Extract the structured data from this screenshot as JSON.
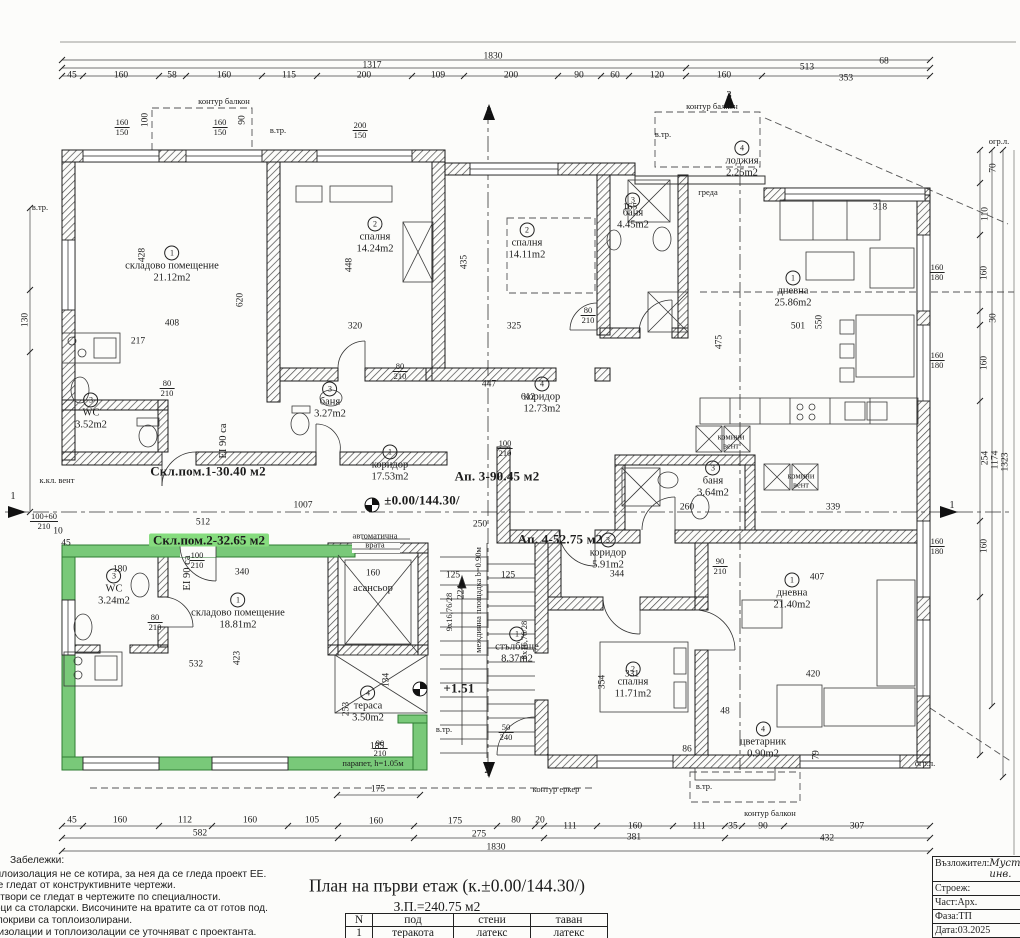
{
  "sheet": {
    "title": "План на първи етаж (к.±0.00/144.30/)",
    "area_total": "З.П.=240.75 м2",
    "notes_heading": "Забележки:",
    "notes": [
      "зидарски. Топлоизолация не се котира, за нея да се гледа проект ЕЕ.",
      "ни и шайби се гледат от конструктивните чертежи.",
      "лационните отвори се гледат в чертежите по специалности.",
      "ите за прозорци са столарски. Височините на вратите са от готов под.",
      "ни, еркери и покриви са топлоизолирани.",
      "риали, хидроизолации и топлоизолации се уточняват с проектанта."
    ],
    "finish_table": {
      "headers": [
        "N",
        "под",
        "стени",
        "таван"
      ],
      "rows": [
        [
          "1",
          "теракота",
          "латекс",
          "латекс"
        ]
      ]
    },
    "title_block": [
      {
        "label": "Възложител:",
        "value": "Мустафа и инв."
      },
      {
        "label": "Строеж:",
        "value": "п ("
      },
      {
        "label": "Част:Арх.",
        "value": "ч"
      },
      {
        "label": "Фаза:ТП",
        "value": "Г"
      },
      {
        "label": "Дата:03.2025",
        "value": ""
      }
    ]
  },
  "plan": {
    "rooms": [
      {
        "n": "1",
        "name": "складово помещение",
        "area": "21.12m2",
        "x": 172,
        "y": 265
      },
      {
        "n": "3",
        "name": "WC",
        "area": "3.52m2",
        "x": 91,
        "y": 412
      },
      {
        "n": "2",
        "name": "спалня",
        "area": "14.24m2",
        "x": 375,
        "y": 236
      },
      {
        "n": "3",
        "name": "баня",
        "area": "3.27m2",
        "x": 330,
        "y": 401
      },
      {
        "n": "2",
        "name": "спалня",
        "area": "14.11m2",
        "x": 527,
        "y": 242
      },
      {
        "n": "3",
        "name": "баня",
        "area": "4.45m2",
        "x": 633,
        "y": 212
      },
      {
        "n": "4",
        "name": "лоджия",
        "area": "2.25m2",
        "x": 742,
        "y": 160
      },
      {
        "n": "1",
        "name": "дневна",
        "area": "25.86m2",
        "x": 793,
        "y": 290
      },
      {
        "n": "4",
        "name": "коридор",
        "area": "12.73m2",
        "x": 542,
        "y": 396
      },
      {
        "n": "1",
        "name": "коридор",
        "area": "17.53m2",
        "x": 390,
        "y": 464
      },
      {
        "n": "3",
        "name": "WC",
        "area": "3.24m2",
        "x": 114,
        "y": 588
      },
      {
        "n": "1",
        "name": "складово помещение",
        "area": "18.81m2",
        "x": 238,
        "y": 612
      },
      {
        "n": "1",
        "name": "стълбище",
        "area": "8.37m2",
        "x": 517,
        "y": 646
      },
      {
        "n": "4",
        "name": "тераса",
        "area": "3.50m2",
        "x": 368,
        "y": 705
      },
      {
        "n": "3",
        "name": "коридор",
        "area": "5.91m2",
        "x": 608,
        "y": 552
      },
      {
        "n": "3",
        "name": "баня",
        "area": "3.64m2",
        "x": 713,
        "y": 480
      },
      {
        "n": "2",
        "name": "спалня",
        "area": "11.71m2",
        "x": 633,
        "y": 681
      },
      {
        "n": "1",
        "name": "дневна",
        "area": "21.40m2",
        "x": 792,
        "y": 592
      },
      {
        "n": "4",
        "name": "цветарник",
        "area": "0.90m2",
        "x": 763,
        "y": 741
      }
    ],
    "annotations": [
      [
        "1830",
        493,
        57,
        "d"
      ],
      [
        "1317",
        372,
        66,
        "d"
      ],
      [
        "513",
        807,
        68,
        "d"
      ],
      [
        "45",
        72,
        76,
        "d"
      ],
      [
        "160",
        121,
        76,
        "d"
      ],
      [
        "58",
        172,
        76,
        "d"
      ],
      [
        "160",
        224,
        76,
        "d"
      ],
      [
        "115",
        289,
        76,
        "d"
      ],
      [
        "200",
        364,
        76,
        "d"
      ],
      [
        "109",
        438,
        76,
        "d"
      ],
      [
        "200",
        511,
        76,
        "d"
      ],
      [
        "90",
        579,
        76,
        "d"
      ],
      [
        "60",
        615,
        76,
        "d"
      ],
      [
        "120",
        657,
        76,
        "d"
      ],
      [
        "160",
        724,
        76,
        "d"
      ],
      [
        "353",
        846,
        79,
        "d"
      ],
      [
        "45",
        72,
        821,
        "d"
      ],
      [
        "160",
        120,
        821,
        "d"
      ],
      [
        "112",
        185,
        821,
        "d"
      ],
      [
        "160",
        250,
        821,
        "d"
      ],
      [
        "105",
        312,
        821,
        "d"
      ],
      [
        "160",
        376,
        822,
        "d"
      ],
      [
        "175",
        455,
        822,
        "d"
      ],
      [
        "80",
        516,
        821,
        "d"
      ],
      [
        "20",
        540,
        821,
        "d"
      ],
      [
        "111",
        570,
        827,
        "d"
      ],
      [
        "160",
        635,
        827,
        "d"
      ],
      [
        "111",
        699,
        827,
        "d"
      ],
      [
        "35",
        733,
        827,
        "d"
      ],
      [
        "90",
        763,
        827,
        "d"
      ],
      [
        "307",
        857,
        827,
        "d"
      ],
      [
        "582",
        200,
        834,
        "d"
      ],
      [
        "275",
        479,
        835,
        "d"
      ],
      [
        "381",
        634,
        838,
        "d"
      ],
      [
        "432",
        827,
        839,
        "d"
      ],
      [
        "1830",
        496,
        848,
        "d"
      ],
      [
        "175",
        378,
        790,
        "d"
      ],
      [
        "130",
        26,
        320,
        "d",
        1
      ],
      [
        "100+60|210",
        44,
        521,
        "f"
      ],
      [
        "10",
        58,
        532,
        "d"
      ],
      [
        "45",
        66,
        544,
        "d"
      ],
      [
        "70",
        994,
        168,
        "d",
        1
      ],
      [
        "110",
        986,
        214,
        "d",
        1
      ],
      [
        "160",
        985,
        273,
        "d",
        1
      ],
      [
        "30",
        994,
        318,
        "d",
        1
      ],
      [
        "160",
        985,
        363,
        "d",
        1
      ],
      [
        "254",
        986,
        458,
        "d",
        1
      ],
      [
        "1174",
        996,
        460,
        "d",
        1
      ],
      [
        "1323",
        1006,
        462,
        "d",
        1
      ],
      [
        "160",
        985,
        546,
        "d",
        1
      ],
      [
        "160|180",
        937,
        272,
        "f"
      ],
      [
        "160|180",
        937,
        360,
        "f"
      ],
      [
        "160|180",
        937,
        546,
        "f"
      ],
      [
        "160|150",
        122,
        127,
        "f"
      ],
      [
        "100",
        146,
        120,
        "d",
        1
      ],
      [
        "160|150",
        220,
        127,
        "f"
      ],
      [
        "90",
        243,
        120,
        "d",
        1
      ],
      [
        "200|150",
        360,
        130,
        "f"
      ],
      [
        "80|210",
        167,
        388,
        "f"
      ],
      [
        "80|210",
        400,
        371,
        "f"
      ],
      [
        "100|210",
        197,
        560,
        "f"
      ],
      [
        "80|210",
        155,
        622,
        "f"
      ],
      [
        "90|210",
        380,
        748,
        "f"
      ],
      [
        "100|210",
        505,
        448,
        "f"
      ],
      [
        "80|210",
        588,
        315,
        "f"
      ],
      [
        "90|210",
        720,
        566,
        "f"
      ],
      [
        "50|240",
        506,
        732,
        "f"
      ],
      [
        "428",
        143,
        255,
        "d",
        1
      ],
      [
        "408",
        172,
        324,
        "d"
      ],
      [
        "217",
        138,
        342,
        "d"
      ],
      [
        "620",
        241,
        300,
        "d",
        1
      ],
      [
        "320",
        355,
        327,
        "d"
      ],
      [
        "448",
        350,
        265,
        "d",
        1
      ],
      [
        "435",
        465,
        262,
        "d",
        1
      ],
      [
        "325",
        514,
        327,
        "d"
      ],
      [
        "447",
        489,
        385,
        "d"
      ],
      [
        "612",
        528,
        398,
        "d"
      ],
      [
        "501",
        798,
        327,
        "d"
      ],
      [
        "550",
        820,
        322,
        "d",
        1
      ],
      [
        "318",
        880,
        208,
        "d"
      ],
      [
        "165",
        630,
        208,
        "d"
      ],
      [
        "68",
        884,
        62,
        "d"
      ],
      [
        "512",
        203,
        523,
        "d"
      ],
      [
        "1007",
        303,
        506,
        "d"
      ],
      [
        "250",
        480,
        525,
        "d"
      ],
      [
        "340",
        242,
        573,
        "d"
      ],
      [
        "180",
        120,
        570,
        "d"
      ],
      [
        "532",
        196,
        665,
        "d"
      ],
      [
        "423",
        238,
        658,
        "d",
        1
      ],
      [
        "185",
        377,
        747,
        "d"
      ],
      [
        "160",
        373,
        574,
        "d"
      ],
      [
        "134",
        387,
        680,
        "d",
        1
      ],
      [
        "253",
        347,
        709,
        "d",
        1
      ],
      [
        "331",
        632,
        675,
        "d"
      ],
      [
        "354",
        603,
        682,
        "d",
        1
      ],
      [
        "344",
        617,
        575,
        "d"
      ],
      [
        "407",
        817,
        578,
        "d"
      ],
      [
        "420",
        813,
        675,
        "d"
      ],
      [
        "339",
        833,
        508,
        "d"
      ],
      [
        "260",
        687,
        508,
        "d"
      ],
      [
        "475",
        720,
        342,
        "d",
        1
      ],
      [
        "125",
        453,
        576,
        "d"
      ],
      [
        "125",
        508,
        576,
        "d"
      ],
      [
        "224",
        462,
        592,
        "d",
        1
      ],
      [
        "48",
        725,
        712,
        "d"
      ],
      [
        "86",
        687,
        750,
        "d"
      ],
      [
        "79",
        817,
        755,
        "d",
        1
      ],
      [
        "контур балкон",
        224,
        101,
        "s"
      ],
      [
        "контур балкон",
        712,
        106,
        "s"
      ],
      [
        "контур балкон",
        770,
        813,
        "s"
      ],
      [
        "контур еркер",
        556,
        789,
        "s"
      ],
      [
        "огр.л.",
        999,
        141,
        "s"
      ],
      [
        "огр.л.",
        925,
        763,
        "s"
      ],
      [
        "в.тр.",
        278,
        130,
        "s"
      ],
      [
        "в.тр.",
        663,
        134,
        "s"
      ],
      [
        "в.тр.",
        40,
        207,
        "s"
      ],
      [
        "в.тр.",
        444,
        729,
        "s"
      ],
      [
        "в.тр.",
        704,
        786,
        "s"
      ],
      [
        "к.кл. вент",
        57,
        480,
        "s"
      ],
      [
        "греда",
        708,
        192,
        "s"
      ],
      [
        "комини|вент",
        731,
        441,
        "t2"
      ],
      [
        "комини|вент",
        801,
        480,
        "t2"
      ],
      [
        "асансьор",
        373,
        589,
        "m"
      ],
      [
        "автоматична|врата",
        375,
        540,
        "t2"
      ],
      [
        "9x16,76/28",
        449,
        612,
        "s",
        1
      ],
      [
        "8x16,76/28",
        524,
        640,
        "s",
        1
      ],
      [
        "междинна площадка b=0.90м",
        478,
        600,
        "s",
        1
      ],
      [
        "EI 90 са",
        224,
        441,
        "m",
        1
      ],
      [
        "EI 90 са",
        188,
        573,
        "m",
        1
      ],
      [
        "парапет, h=1.05м",
        373,
        763,
        "s"
      ],
      [
        "±0.00/144.30/",
        422,
        500,
        "b"
      ],
      [
        "+1.51",
        459,
        688,
        "b"
      ],
      [
        "Ап. 3-90.45 м2",
        497,
        476,
        "b"
      ],
      [
        "Ап. 4-52.75 м2",
        560,
        539,
        "b"
      ],
      [
        "Скл.пом.1-30.40 м2",
        208,
        471,
        "b"
      ],
      [
        "Скл.пом.2-32.65 м2",
        209,
        540,
        "bg"
      ],
      [
        "1",
        13,
        497,
        "m"
      ],
      [
        "1",
        952,
        506,
        "m"
      ],
      [
        "2",
        489,
        112,
        "m"
      ],
      [
        "2",
        487,
        771,
        "m"
      ],
      [
        "3",
        729,
        96,
        "m"
      ]
    ]
  },
  "colors": {
    "highlight_green": "#86dc7e",
    "wall_green": "#79c979",
    "line": "#1c1c1c",
    "paper": "#fcfcfa"
  }
}
